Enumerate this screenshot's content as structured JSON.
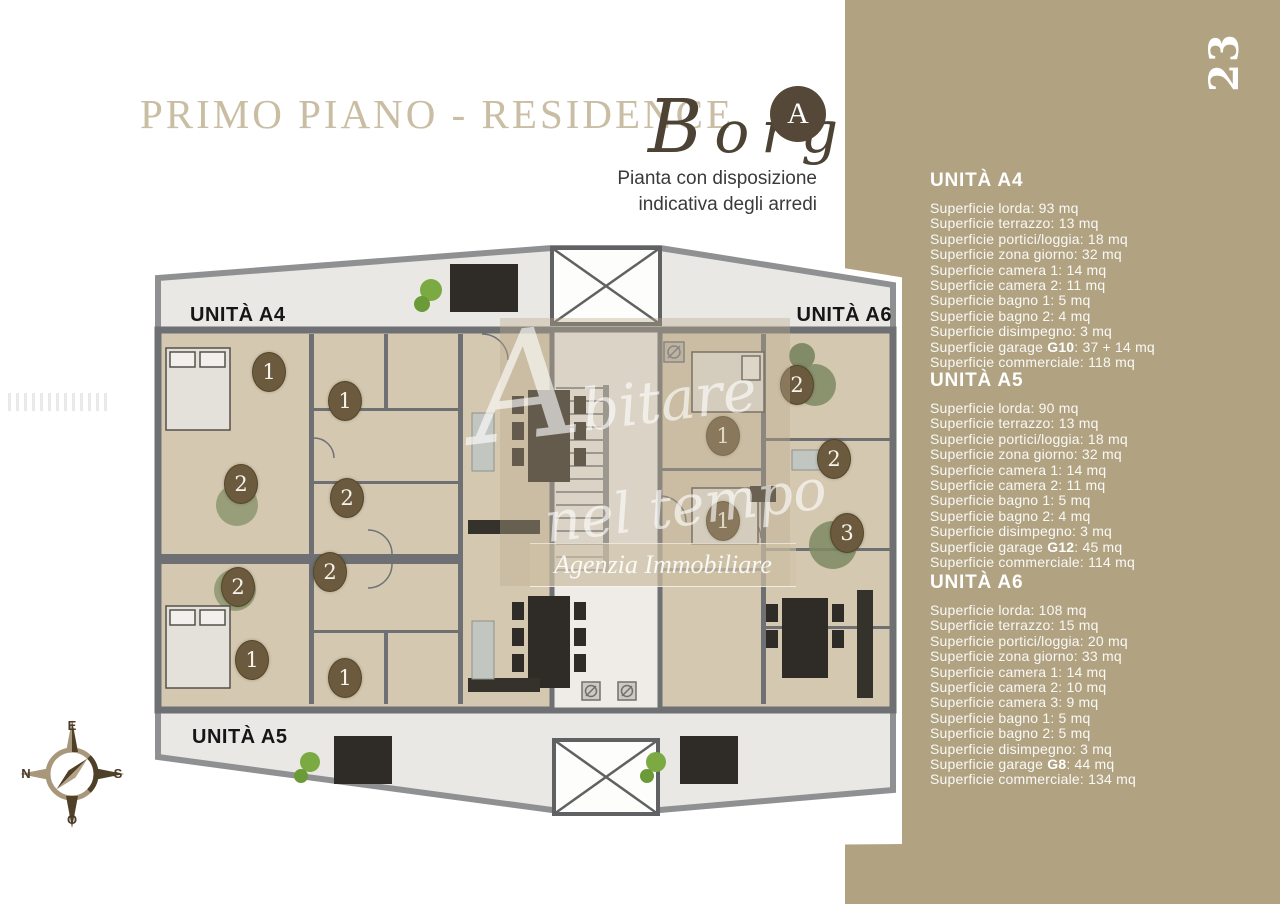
{
  "page": {
    "number": "23"
  },
  "header": {
    "title": "PRIMO PIANO - RESIDENCE",
    "brand_script": "Borg",
    "brand_badge": "A",
    "subtitle_line1": "Pianta con disposizione",
    "subtitle_line2": "indicativa degli arredi"
  },
  "plan": {
    "unit_labels": {
      "a4": "UNITÀ A4",
      "a6": "UNITÀ A6",
      "a5": "UNITÀ A5"
    },
    "markers": [
      {
        "label": "1"
      },
      {
        "label": "1"
      },
      {
        "label": "2"
      },
      {
        "label": "2"
      },
      {
        "label": "2"
      },
      {
        "label": "2"
      },
      {
        "label": "1"
      },
      {
        "label": "1"
      },
      {
        "label": "2"
      },
      {
        "label": "1"
      },
      {
        "label": "2"
      },
      {
        "label": "1"
      },
      {
        "label": "3"
      }
    ],
    "watermark": {
      "script_line1": "Abitare",
      "script_line2": "nel tempo",
      "agency": "Agenzia Immobiliare"
    }
  },
  "compass": {
    "top": "E",
    "right": "S",
    "bottom": "O",
    "left": "N"
  },
  "colors": {
    "tan_panel": "#b1a382",
    "title": "#c9bda3",
    "marker": "#6b5a3e",
    "walls": "#6e7074",
    "room": "#d5c8b1",
    "terrace": "#eae8e4"
  },
  "sidebar": {
    "sections": [
      {
        "title": "UNITÀ A4",
        "lines": [
          "Superficie lorda: 93 mq",
          "Superficie terrazzo: 13 mq",
          "Superficie portici/loggia: 18 mq",
          "Superficie zona giorno: 32 mq",
          "Superficie camera 1: 14 mq",
          "Superficie camera 2: 11 mq",
          "Superficie bagno 1: 5 mq",
          "Superficie bagno 2: 4 mq",
          "Superficie disimpegno: 3 mq"
        ],
        "garage_prefix": "Superficie garage ",
        "garage_code": "G10",
        "garage_suffix": ": 37 + 14 mq",
        "commercial": "Superficie commerciale: 118 mq"
      },
      {
        "title": "UNITÀ A5",
        "lines": [
          "Superficie lorda: 90 mq",
          "Superficie terrazzo: 13 mq",
          "Superficie portici/loggia: 18 mq",
          "Superficie zona giorno: 32 mq",
          "Superficie camera 1: 14 mq",
          "Superficie camera 2: 11 mq",
          "Superficie bagno 1: 5 mq",
          "Superficie bagno 2: 4 mq",
          "Superficie disimpegno: 3 mq"
        ],
        "garage_prefix": "Superficie garage ",
        "garage_code": "G12",
        "garage_suffix": ": 45 mq",
        "commercial": "Superficie commerciale: 114 mq"
      },
      {
        "title": "UNITÀ A6",
        "lines": [
          "Superficie lorda: 108 mq",
          "Superficie terrazzo: 15 mq",
          "Superficie portici/loggia: 20 mq",
          "Superficie zona giorno: 33 mq",
          "Superficie camera 1: 14 mq",
          "Superficie camera 2: 10 mq",
          "Superficie camera 3: 9 mq",
          "Superficie bagno 1: 5 mq",
          "Superficie bagno 2: 5 mq",
          "Superficie disimpegno: 3 mq"
        ],
        "garage_prefix": "Superficie garage ",
        "garage_code": "G8",
        "garage_suffix": ": 44 mq",
        "commercial": "Superficie commerciale: 134 mq"
      }
    ]
  }
}
